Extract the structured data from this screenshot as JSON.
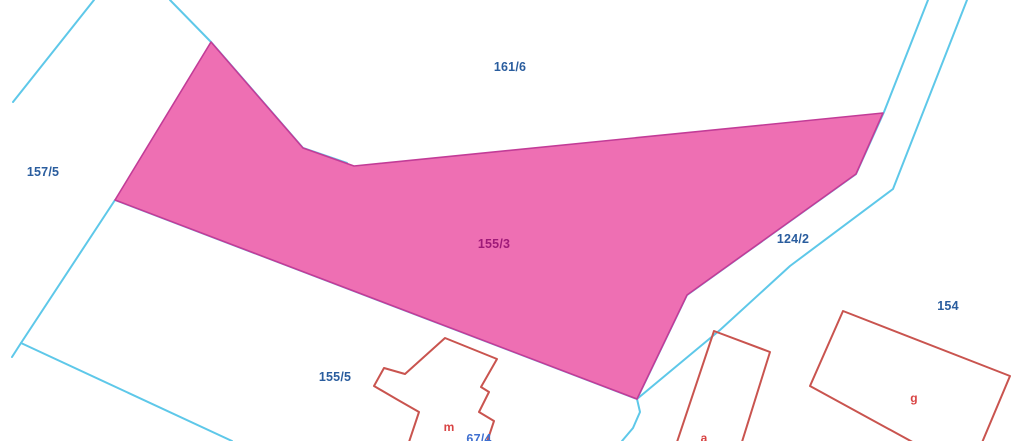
{
  "map": {
    "type": "cadastral-parcel-map",
    "highlighted_parcel": {
      "id": "155/3"
    },
    "parcel_labels": {
      "p161_6": "161/6",
      "p157_5": "157/5",
      "p155_3": "155/3",
      "p124_2": "124/2",
      "p154": "154",
      "p155_5": "155/5",
      "p67_4": "67/4"
    },
    "building_labels": {
      "m": "m",
      "g": "g",
      "a": "a"
    },
    "colors": {
      "background": "#ffffff",
      "parcel_boundary": "#5ec8e9",
      "highlight_fill": "#ee6fb3",
      "highlight_stroke": "#c23c97",
      "building_outline": "#c9544f",
      "building_label": "#d84444",
      "parcel_label_blue": "#2a5d9e",
      "parcel_label_magenta": "#9e1a78",
      "clipped_label_blue": "#3e6fd0"
    }
  }
}
